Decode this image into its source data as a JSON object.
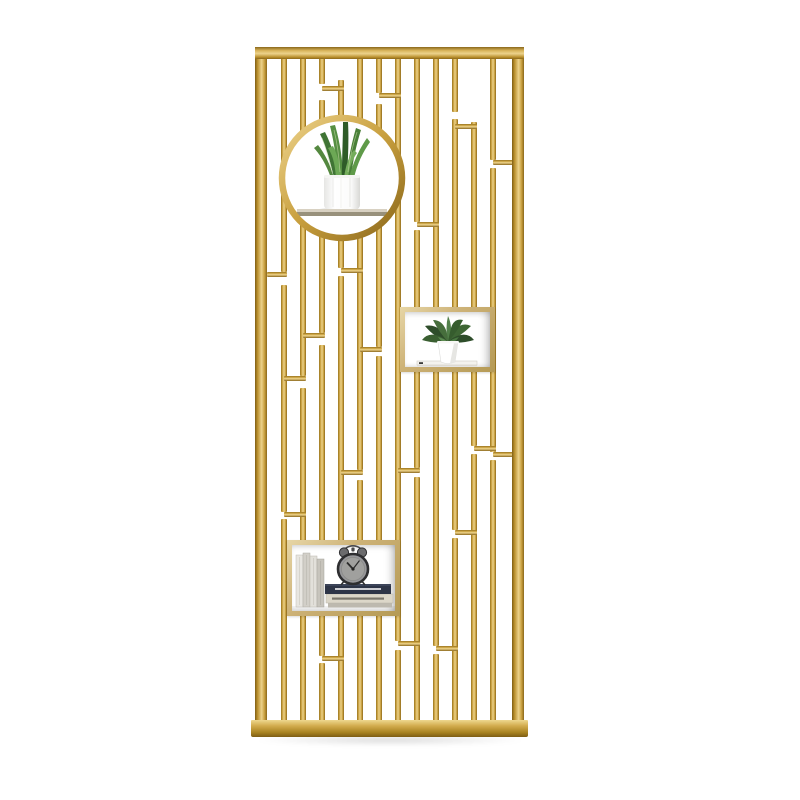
{
  "meta": {
    "description": "product photo of a gold stainless-steel decorative room divider screen with irregular vertical slats and three display niches",
    "background_color": "#ffffff"
  },
  "colors": {
    "bg": "#ffffff",
    "gold_dark": "#8a671b",
    "gold_mid": "#c89f3e",
    "gold_light": "#ecd28b",
    "shelf_top": "#d8d1c2",
    "shelf_edge": "#98917c",
    "leaf_dark": "#2f5c28",
    "leaf_mid": "#4a8039",
    "leaf_light": "#6ca855",
    "leaf_stripe": "#c2d9a4",
    "pot_white": "#ffffff",
    "pot_shade": "#dcdcd9",
    "box_frame": "#cdb277",
    "box_frame_light": "#e7d6a6",
    "box_frame_dark": "#a8904f",
    "plank_white": "#f4f3ef",
    "plank_edge": "#cfccc4",
    "book_navy": "#2e3547",
    "book_cream": "#dcd7c9",
    "book_gray_a": "#e8e6e1",
    "book_gray_b": "#d2cfc8",
    "book_gray_c": "#c7c4bc",
    "clock_rim": "#2e2e30",
    "clock_face": "#a0a09e",
    "clock_bell": "#6b6b6d"
  },
  "panel": {
    "bar_width": 6,
    "stub_height": 5,
    "frame": [
      {
        "part": "left",
        "x": 255,
        "y": 47,
        "w": 12,
        "h": 688
      },
      {
        "part": "right",
        "x": 512,
        "y": 47,
        "w": 12,
        "h": 688
      },
      {
        "part": "top",
        "x": 255,
        "y": 47,
        "w": 269,
        "h": 12
      },
      {
        "part": "bottom",
        "x": 251,
        "y": 720,
        "w": 277,
        "h": 17
      }
    ],
    "columns": [
      {
        "x": 284,
        "segments": [
          [
            57,
            272
          ],
          [
            285,
            512
          ],
          [
            519,
            723
          ]
        ]
      },
      {
        "x": 303,
        "segments": [
          [
            57,
            376
          ],
          [
            388,
            723
          ]
        ]
      },
      {
        "x": 322,
        "segments": [
          [
            57,
            84
          ],
          [
            100,
            333
          ],
          [
            345,
            656
          ],
          [
            663,
            723
          ]
        ]
      },
      {
        "x": 341,
        "segments": [
          [
            80,
            268
          ],
          [
            276,
            723
          ]
        ]
      },
      {
        "x": 360,
        "segments": [
          [
            57,
            470
          ],
          [
            480,
            723
          ]
        ]
      },
      {
        "x": 379,
        "segments": [
          [
            57,
            93
          ],
          [
            104,
            347
          ],
          [
            356,
            723
          ]
        ]
      },
      {
        "x": 398,
        "segments": [
          [
            57,
            641
          ],
          [
            650,
            723
          ]
        ]
      },
      {
        "x": 417,
        "segments": [
          [
            57,
            222
          ],
          [
            230,
            468
          ],
          [
            477,
            723
          ]
        ]
      },
      {
        "x": 436,
        "segments": [
          [
            57,
            646
          ],
          [
            654,
            723
          ]
        ]
      },
      {
        "x": 455,
        "segments": [
          [
            57,
            112
          ],
          [
            119,
            530
          ],
          [
            538,
            723
          ]
        ]
      },
      {
        "x": 474,
        "segments": [
          [
            122,
            446
          ],
          [
            454,
            723
          ]
        ]
      },
      {
        "x": 493,
        "segments": [
          [
            57,
            160
          ],
          [
            168,
            452
          ],
          [
            460,
            723
          ]
        ]
      }
    ],
    "stubs": [
      [
        267,
        287,
        272
      ],
      [
        284,
        306,
        512
      ],
      [
        284,
        306,
        376
      ],
      [
        322,
        344,
        86
      ],
      [
        303,
        325,
        333
      ],
      [
        322,
        344,
        656
      ],
      [
        341,
        363,
        268
      ],
      [
        341,
        363,
        470
      ],
      [
        379,
        401,
        93
      ],
      [
        360,
        382,
        347
      ],
      [
        398,
        420,
        641
      ],
      [
        417,
        439,
        222
      ],
      [
        398,
        420,
        468
      ],
      [
        436,
        458,
        646
      ],
      [
        455,
        477,
        124
      ],
      [
        455,
        477,
        530
      ],
      [
        474,
        496,
        446
      ],
      [
        493,
        515,
        160
      ],
      [
        493,
        515,
        452
      ]
    ]
  },
  "features": {
    "circle_display": {
      "cx": 342,
      "cy": 178,
      "outer_radius": 63,
      "ring_thickness": 6.5,
      "shelf_y": 210,
      "contents": [
        "snake-plant",
        "white-pot",
        "shelf"
      ]
    },
    "middle_box": {
      "x": 400,
      "y": 307,
      "w": 95,
      "h": 65,
      "frame_thickness": 5,
      "contents": [
        "leafy-potted-plant",
        "white-pot",
        "white-base-plank"
      ]
    },
    "lower_box": {
      "x": 287,
      "y": 540,
      "w": 113,
      "h": 76,
      "frame_thickness": 5,
      "contents": [
        "standing-books",
        "stacked-books",
        "twin-bell-alarm-clock"
      ],
      "standing_book_count": 4,
      "stacked_book_count": 3
    }
  }
}
